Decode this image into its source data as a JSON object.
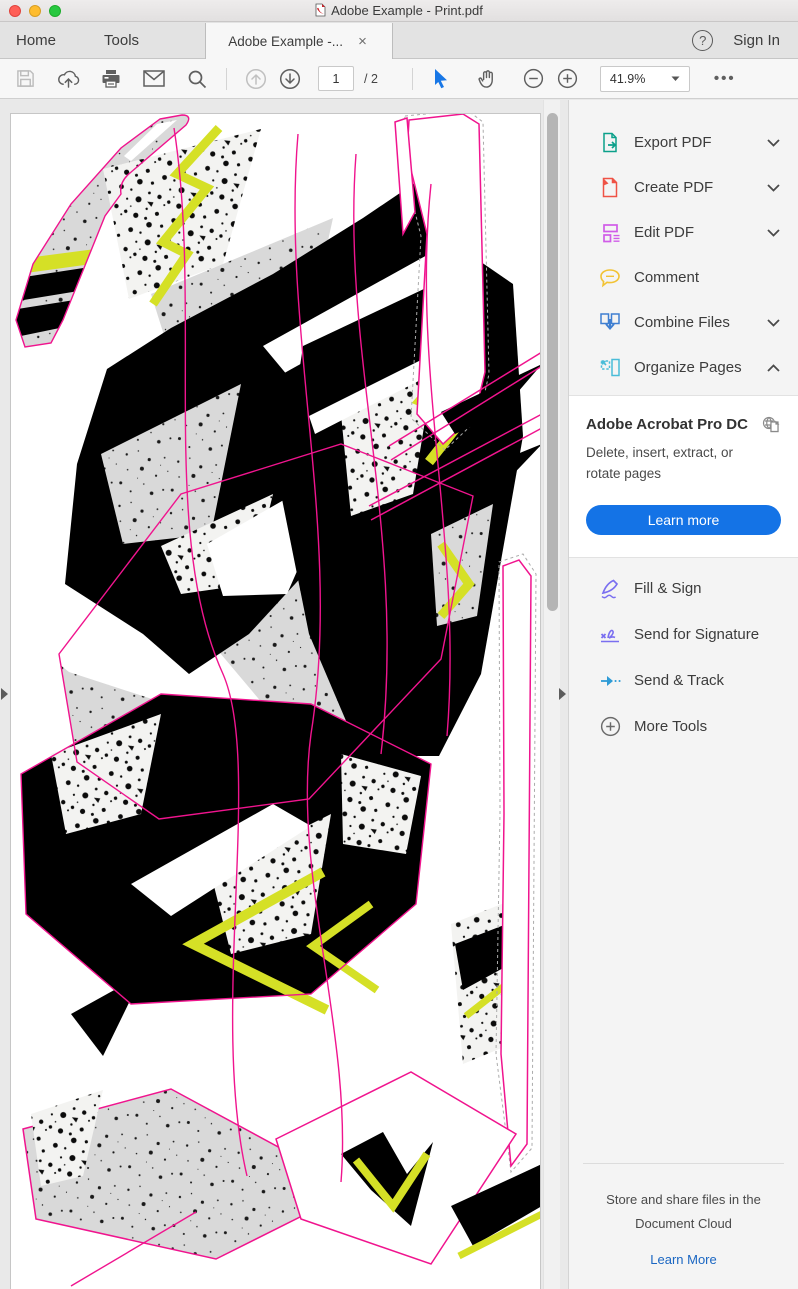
{
  "theme": {
    "accent_blue": "#1473e6",
    "link_blue": "#1a66c2",
    "pink": "#f0148e",
    "yellow": "#d5e026",
    "artwork_gray": "#d9d9d9"
  },
  "titlebar": {
    "title": "Adobe Example - Print.pdf"
  },
  "tabbar": {
    "home": "Home",
    "tools": "Tools",
    "active_tab": "Adobe Example -...",
    "close": "×",
    "help": "?",
    "sign_in": "Sign In"
  },
  "toolbar": {
    "page_current": "1",
    "page_total": "/ 2",
    "zoom_level": "41.9%",
    "more": "•••"
  },
  "sidebar": {
    "tools_primary": [
      {
        "label": "Export PDF",
        "icon": "export-pdf-icon",
        "chevron": "down"
      },
      {
        "label": "Create PDF",
        "icon": "create-pdf-icon",
        "chevron": "down"
      },
      {
        "label": "Edit PDF",
        "icon": "edit-pdf-icon",
        "chevron": "down"
      },
      {
        "label": "Comment",
        "icon": "comment-icon",
        "chevron": ""
      },
      {
        "label": "Combine Files",
        "icon": "combine-files-icon",
        "chevron": "down"
      },
      {
        "label": "Organize Pages",
        "icon": "organize-pages-icon",
        "chevron": "up"
      }
    ],
    "panel": {
      "title": "Adobe Acrobat Pro DC",
      "description": "Delete, insert, extract, or rotate pages",
      "button_label": "Learn more"
    },
    "tools_secondary": [
      {
        "label": "Fill & Sign",
        "icon": "fill-sign-icon",
        "chevron": ""
      },
      {
        "label": "Send for Signature",
        "icon": "send-signature-icon",
        "chevron": ""
      },
      {
        "label": "Send & Track",
        "icon": "send-track-icon",
        "chevron": ""
      },
      {
        "label": "More Tools",
        "icon": "more-tools-icon",
        "chevron": ""
      }
    ],
    "footer": {
      "line1": "Store and share files in the",
      "line2": "Document Cloud",
      "link": "Learn More"
    }
  }
}
